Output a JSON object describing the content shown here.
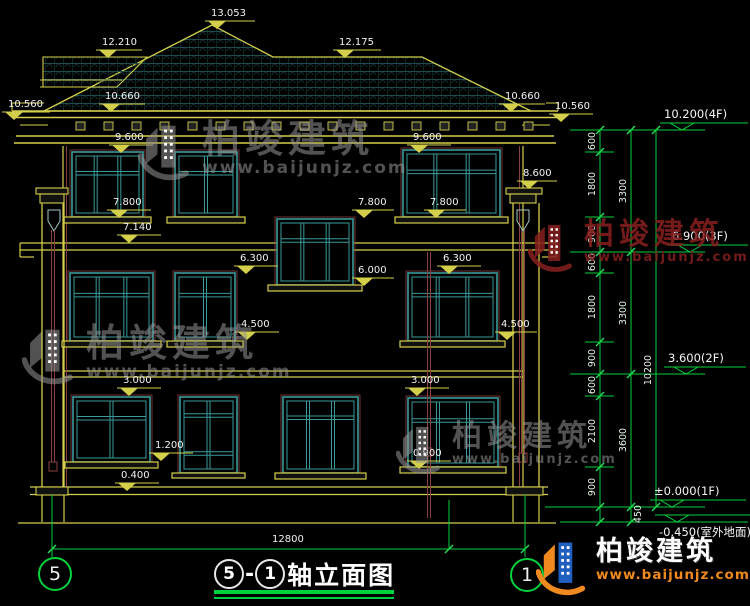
{
  "drawing": {
    "title": {
      "left_axis": "5",
      "sep": "-",
      "right_axis": "1",
      "text": "轴立面图"
    },
    "axes": {
      "left": "5",
      "right": "1"
    },
    "bottom_dim": {
      "label": "12800"
    },
    "watermark": {
      "text": "柏竣建筑",
      "sub": "www.baijunjz.com"
    },
    "logo": {
      "name": "柏竣建筑",
      "url": "www.baijunjz.com"
    },
    "colors": {
      "line_yellow": "#d4cf4a",
      "window_teal": "#3a9a9a",
      "dim_green": "#00d23c",
      "detail_maroon": "#8a4040",
      "text_white": "#f2f2f2",
      "logo_blue": "#1f5fbf",
      "logo_orange": "#f08a1e",
      "wm_gray": "rgba(150,150,150,0.55)",
      "wm_maroon": "rgba(135,30,30,0.85)"
    },
    "facade_markers": [
      {
        "t": "13.053",
        "x": 205,
        "line": 21,
        "len": 50
      },
      {
        "t": "12.210",
        "x": 96,
        "line": 50,
        "len": 46
      },
      {
        "t": "12.175",
        "x": 333,
        "line": 50,
        "len": 48
      },
      {
        "t": "10.560",
        "x": 2,
        "line": 112,
        "len": 48
      },
      {
        "t": "10.660",
        "x": 99,
        "line": 104,
        "len": 46
      },
      {
        "t": "10.660",
        "x": 499,
        "line": 104,
        "len": 46
      },
      {
        "t": "10.560",
        "x": 549,
        "line": 114,
        "len": 44
      },
      {
        "t": "9.600",
        "x": 109,
        "line": 145,
        "len": 44
      },
      {
        "t": "9.600",
        "x": 407,
        "line": 145,
        "len": 44
      },
      {
        "t": "8.600",
        "x": 517,
        "line": 181,
        "len": 40
      },
      {
        "t": "7.800",
        "x": 107,
        "line": 210,
        "len": 44
      },
      {
        "t": "7.800",
        "x": 352,
        "line": 210,
        "len": 42
      },
      {
        "t": "7.800",
        "x": 424,
        "line": 210,
        "len": 42
      },
      {
        "t": "7.140",
        "x": 117,
        "line": 235,
        "len": 44
      },
      {
        "t": "6.300",
        "x": 234,
        "line": 266,
        "len": 44
      },
      {
        "t": "6.300",
        "x": 437,
        "line": 266,
        "len": 44
      },
      {
        "t": "6.000",
        "x": 352,
        "line": 278,
        "len": 42
      },
      {
        "t": "4.500",
        "x": 235,
        "line": 332,
        "len": 44
      },
      {
        "t": "4.500",
        "x": 495,
        "line": 332,
        "len": 42
      },
      {
        "t": "3.000",
        "x": 117,
        "line": 388,
        "len": 44
      },
      {
        "t": "3.000",
        "x": 405,
        "line": 388,
        "len": 44
      },
      {
        "t": "1.200",
        "x": 149,
        "line": 453,
        "len": 44
      },
      {
        "t": "0.900",
        "x": 407,
        "line": 461,
        "len": 44
      },
      {
        "t": "0.400",
        "x": 115,
        "line": 483,
        "len": 44
      }
    ],
    "level_markers": [
      {
        "t": "10.200(4F)",
        "x": 660,
        "target": 130,
        "len": 88,
        "below": false
      },
      {
        "t": "6.900(3F)",
        "x": 668,
        "target": 252,
        "len": 80,
        "below": false
      },
      {
        "t": "3.600(2F)",
        "x": 664,
        "target": 374,
        "len": 82,
        "below": false
      },
      {
        "t": "±0.000(1F)",
        "x": 650,
        "target": 507,
        "len": 96,
        "below": false
      },
      {
        "t": "-0.450(室外地面)",
        "x": 655,
        "target": 522,
        "len": 95,
        "below": true
      }
    ],
    "chains": [
      {
        "x": 600,
        "y1": 130,
        "y2": 522,
        "ticks": [
          130,
          152,
          217,
          252,
          273,
          342,
          374,
          396,
          467,
          507,
          522
        ]
      },
      {
        "x": 631,
        "y1": 130,
        "y2": 522,
        "ticks": [
          130,
          252,
          374,
          507,
          522
        ]
      },
      {
        "x": 656,
        "y1": 130,
        "y2": 507,
        "ticks": [
          130,
          507
        ]
      }
    ],
    "dim_labels": [
      {
        "t": "600",
        "cx": 592,
        "cy": 141
      },
      {
        "t": "1800",
        "cx": 592,
        "cy": 184
      },
      {
        "t": "900",
        "cx": 592,
        "cy": 234
      },
      {
        "t": "600",
        "cx": 592,
        "cy": 262
      },
      {
        "t": "1800",
        "cx": 592,
        "cy": 307
      },
      {
        "t": "900",
        "cx": 592,
        "cy": 358
      },
      {
        "t": "600",
        "cx": 592,
        "cy": 385
      },
      {
        "t": "2100",
        "cx": 592,
        "cy": 431
      },
      {
        "t": "900",
        "cx": 592,
        "cy": 487
      },
      {
        "t": "450",
        "cx": 638,
        "cy": 514
      },
      {
        "t": "3300",
        "cx": 623,
        "cy": 191
      },
      {
        "t": "3300",
        "cx": 623,
        "cy": 313
      },
      {
        "t": "3600",
        "cx": 623,
        "cy": 440
      },
      {
        "t": "10200",
        "cx": 648,
        "cy": 370
      }
    ],
    "watermarks": [
      {
        "x": 138,
        "y": 120,
        "icon": 58,
        "fs": 38,
        "sfs": 17,
        "color": "gray"
      },
      {
        "x": 22,
        "y": 324,
        "icon": 58,
        "fs": 38,
        "sfs": 17,
        "color": "gray"
      },
      {
        "x": 528,
        "y": 220,
        "icon": 50,
        "fs": 30,
        "sfs": 13,
        "color": "maroon"
      },
      {
        "x": 396,
        "y": 422,
        "icon": 50,
        "fs": 30,
        "sfs": 13,
        "color": "gray"
      }
    ]
  },
  "figure": {
    "roof": {
      "main": "44,111 212,25 273,57 422,57 531,111",
      "wing": "43,57 147,57 117,87 43,87",
      "wing_lines": [
        [
          40,
          80,
          122,
          80
        ],
        [
          40,
          87,
          114,
          87
        ]
      ],
      "eave_lines": [
        [
          12,
          111,
          558,
          111
        ],
        [
          12,
          117.5,
          558,
          117.5
        ],
        [
          16,
          136,
          554,
          136
        ],
        [
          14,
          143,
          556,
          143
        ]
      ],
      "end_steps": [
        [
          12,
          103,
          44,
          103
        ],
        [
          12,
          103,
          12,
          111
        ],
        [
          546,
          103,
          558,
          103
        ],
        [
          558,
          103,
          558,
          111
        ],
        [
          20,
          125,
          48,
          125
        ],
        [
          522,
          125,
          550,
          125
        ]
      ],
      "brackets": {
        "y": 122,
        "w": 9,
        "h": 8,
        "from": 76,
        "to": 532,
        "step": 28
      }
    },
    "walls": {
      "yellow_lines": [
        [
          63,
          146,
          63,
          487
        ],
        [
          523,
          146,
          523,
          487
        ],
        [
          20,
          243,
          277,
          243
        ],
        [
          353,
          243,
          556,
          243
        ],
        [
          20,
          250,
          277,
          250
        ],
        [
          353,
          250,
          556,
          250
        ],
        [
          63,
          371,
          523,
          371
        ],
        [
          63,
          377,
          523,
          377
        ],
        [
          30,
          487,
          548,
          487
        ],
        [
          30,
          494.5,
          548,
          494.5
        ],
        [
          18,
          523,
          556,
          523
        ],
        [
          42,
          495,
          42,
          522
        ],
        [
          64,
          495,
          64,
          522
        ],
        [
          513,
          495,
          513,
          522
        ],
        [
          539,
          495,
          539,
          522
        ],
        [
          20,
          243,
          20,
          257
        ],
        [
          20,
          257,
          34,
          257
        ],
        [
          556,
          243,
          556,
          257
        ],
        [
          556,
          257,
          542,
          257
        ]
      ],
      "maroon_lines": [
        [
          66.5,
          146,
          66.5,
          487
        ],
        [
          519.5,
          146,
          519.5,
          487
        ]
      ]
    },
    "columns": [
      {
        "caps": [
          [
            36,
            188,
            32,
            6
          ],
          [
            40,
            194,
            24,
            9
          ]
        ],
        "shaft": [
          [
            42,
            203,
            42,
            487
          ],
          [
            64,
            203,
            64,
            487
          ]
        ],
        "base": [
          [
            36,
            487,
            32,
            8
          ]
        ],
        "shield": [
          48,
          210
        ],
        "pipe": {
          "x": 53,
          "y1": 230,
          "y2": 462,
          "shoe": [
            49,
            462,
            8,
            9
          ]
        }
      },
      {
        "caps": [
          [
            506,
            188,
            36,
            6
          ],
          [
            510,
            194,
            26,
            9
          ]
        ],
        "shaft": [
          [
            513,
            203,
            513,
            487
          ],
          [
            539,
            203,
            539,
            487
          ]
        ],
        "base": [
          [
            506,
            487,
            37,
            8
          ]
        ],
        "shield": [
          517,
          210
        ],
        "pipe": {
          "x": 523,
          "y1": 230,
          "y2": 453,
          "shoe": [
            519,
            453,
            8,
            9
          ]
        }
      }
    ],
    "extra_pipe": {
      "x": 429,
      "y1": 252,
      "y2": 518,
      "shoe": [
        424,
        448,
        8,
        8
      ]
    },
    "windows": [
      {
        "x": 72,
        "y": 152,
        "w": 71,
        "h": 65,
        "cols": 3,
        "rails": [
          0.3
        ],
        "sill": [
          64,
          217,
          87,
          6
        ]
      },
      {
        "x": 175,
        "y": 152,
        "w": 62,
        "h": 65,
        "cols": 2,
        "rails": [
          0.3
        ],
        "sill": [
          167,
          217,
          78,
          6
        ]
      },
      {
        "x": 403,
        "y": 150,
        "w": 97,
        "h": 67,
        "cols": 3,
        "rails": [
          0.3
        ],
        "sill": [
          395,
          217,
          113,
          6
        ]
      },
      {
        "x": 277,
        "y": 219,
        "w": 76,
        "h": 66,
        "cols": 3,
        "rails": [
          0.3
        ],
        "sill": [
          268,
          285,
          94,
          6
        ]
      },
      {
        "x": 70,
        "y": 273,
        "w": 83,
        "h": 68,
        "cols": 3,
        "rails": [
          0.3
        ],
        "sill": [
          62,
          341,
          99,
          6
        ]
      },
      {
        "x": 175,
        "y": 273,
        "w": 60,
        "h": 68,
        "cols": 2,
        "rails": [
          0.3
        ],
        "sill": [
          167,
          341,
          76,
          6
        ]
      },
      {
        "x": 408,
        "y": 273,
        "w": 89,
        "h": 68,
        "cols": 3,
        "rails": [
          0.3
        ],
        "sill": [
          400,
          341,
          105,
          6
        ]
      },
      {
        "x": 73,
        "y": 397,
        "w": 77,
        "h": 65,
        "cols": 2,
        "rails": [
          0.3
        ],
        "sill": [
          65,
          462,
          93,
          6
        ]
      },
      {
        "x": 180,
        "y": 397,
        "w": 57,
        "h": 76,
        "cols": 2,
        "rails": [
          0.22,
          0.72
        ],
        "sill": [
          172,
          473,
          73,
          5
        ]
      },
      {
        "x": 283,
        "y": 397,
        "w": 75,
        "h": 76,
        "cols": 3,
        "rails": [
          0.25
        ],
        "sill": [
          275,
          473,
          91,
          6
        ]
      },
      {
        "x": 408,
        "y": 398,
        "w": 90,
        "h": 69,
        "cols": 3,
        "rails": [
          0.3
        ],
        "sill": [
          400,
          467,
          106,
          6
        ]
      }
    ],
    "ext_lines": [
      [
        570,
        130,
        705,
        130
      ],
      [
        570,
        252,
        705,
        252
      ],
      [
        570,
        374,
        705,
        374
      ],
      [
        545,
        507,
        705,
        507
      ],
      [
        560,
        522,
        748,
        522
      ],
      [
        585,
        152,
        614,
        152
      ],
      [
        585,
        217,
        614,
        217
      ],
      [
        585,
        273,
        614,
        273
      ],
      [
        585,
        342,
        614,
        342
      ],
      [
        585,
        396,
        614,
        396
      ],
      [
        585,
        467,
        614,
        467
      ]
    ],
    "bottom_dim": {
      "y": 549,
      "x1": 52,
      "x2": 525,
      "mid_tick": 449,
      "verticals": [
        [
          52,
          495,
          52,
          557
        ],
        [
          525,
          495,
          525,
          557
        ],
        [
          449,
          500,
          449,
          549
        ]
      ]
    },
    "bubbles": [
      {
        "cx": 53,
        "cy": 572
      },
      {
        "cx": 525,
        "cy": 573
      }
    ]
  }
}
